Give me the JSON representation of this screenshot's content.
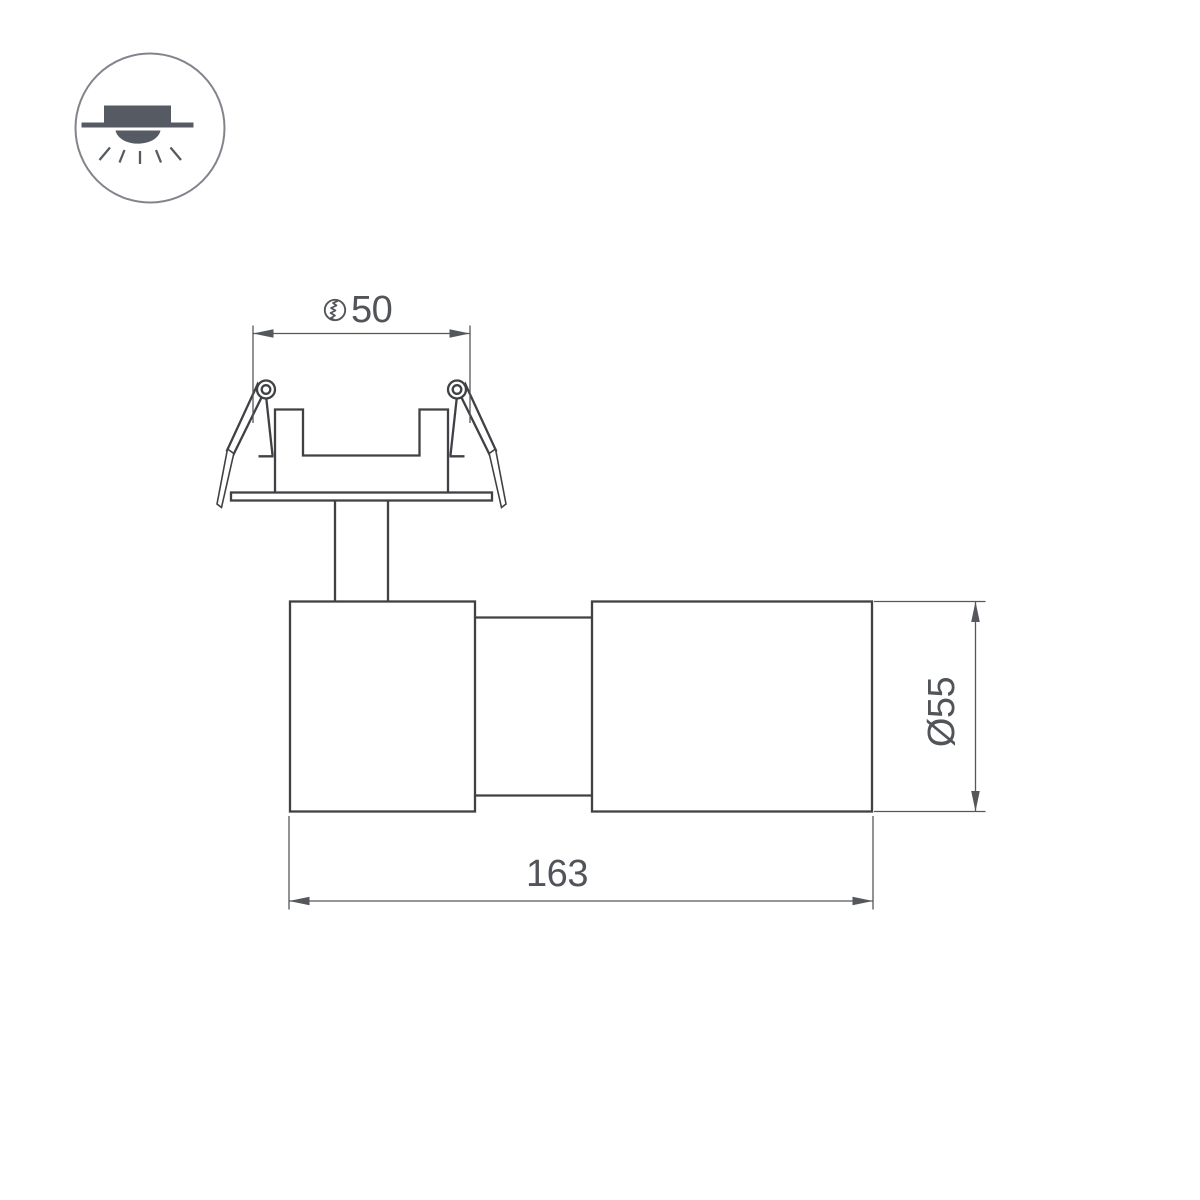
{
  "legend_icon": {
    "name": "recessed-downlight-icon"
  },
  "dimensions": {
    "cutout": {
      "symbol_icon": "hole-cutout-icon",
      "value": "50"
    },
    "body_diameter": {
      "label": "Ø55"
    },
    "overall_length": {
      "value": "163"
    }
  },
  "colors": {
    "background": "#ffffff",
    "object_line": "#3f4144",
    "dimension_line": "#54575b",
    "label_text": "#515459",
    "icon_fill": "#565b63",
    "icon_ring": "#81858b"
  }
}
